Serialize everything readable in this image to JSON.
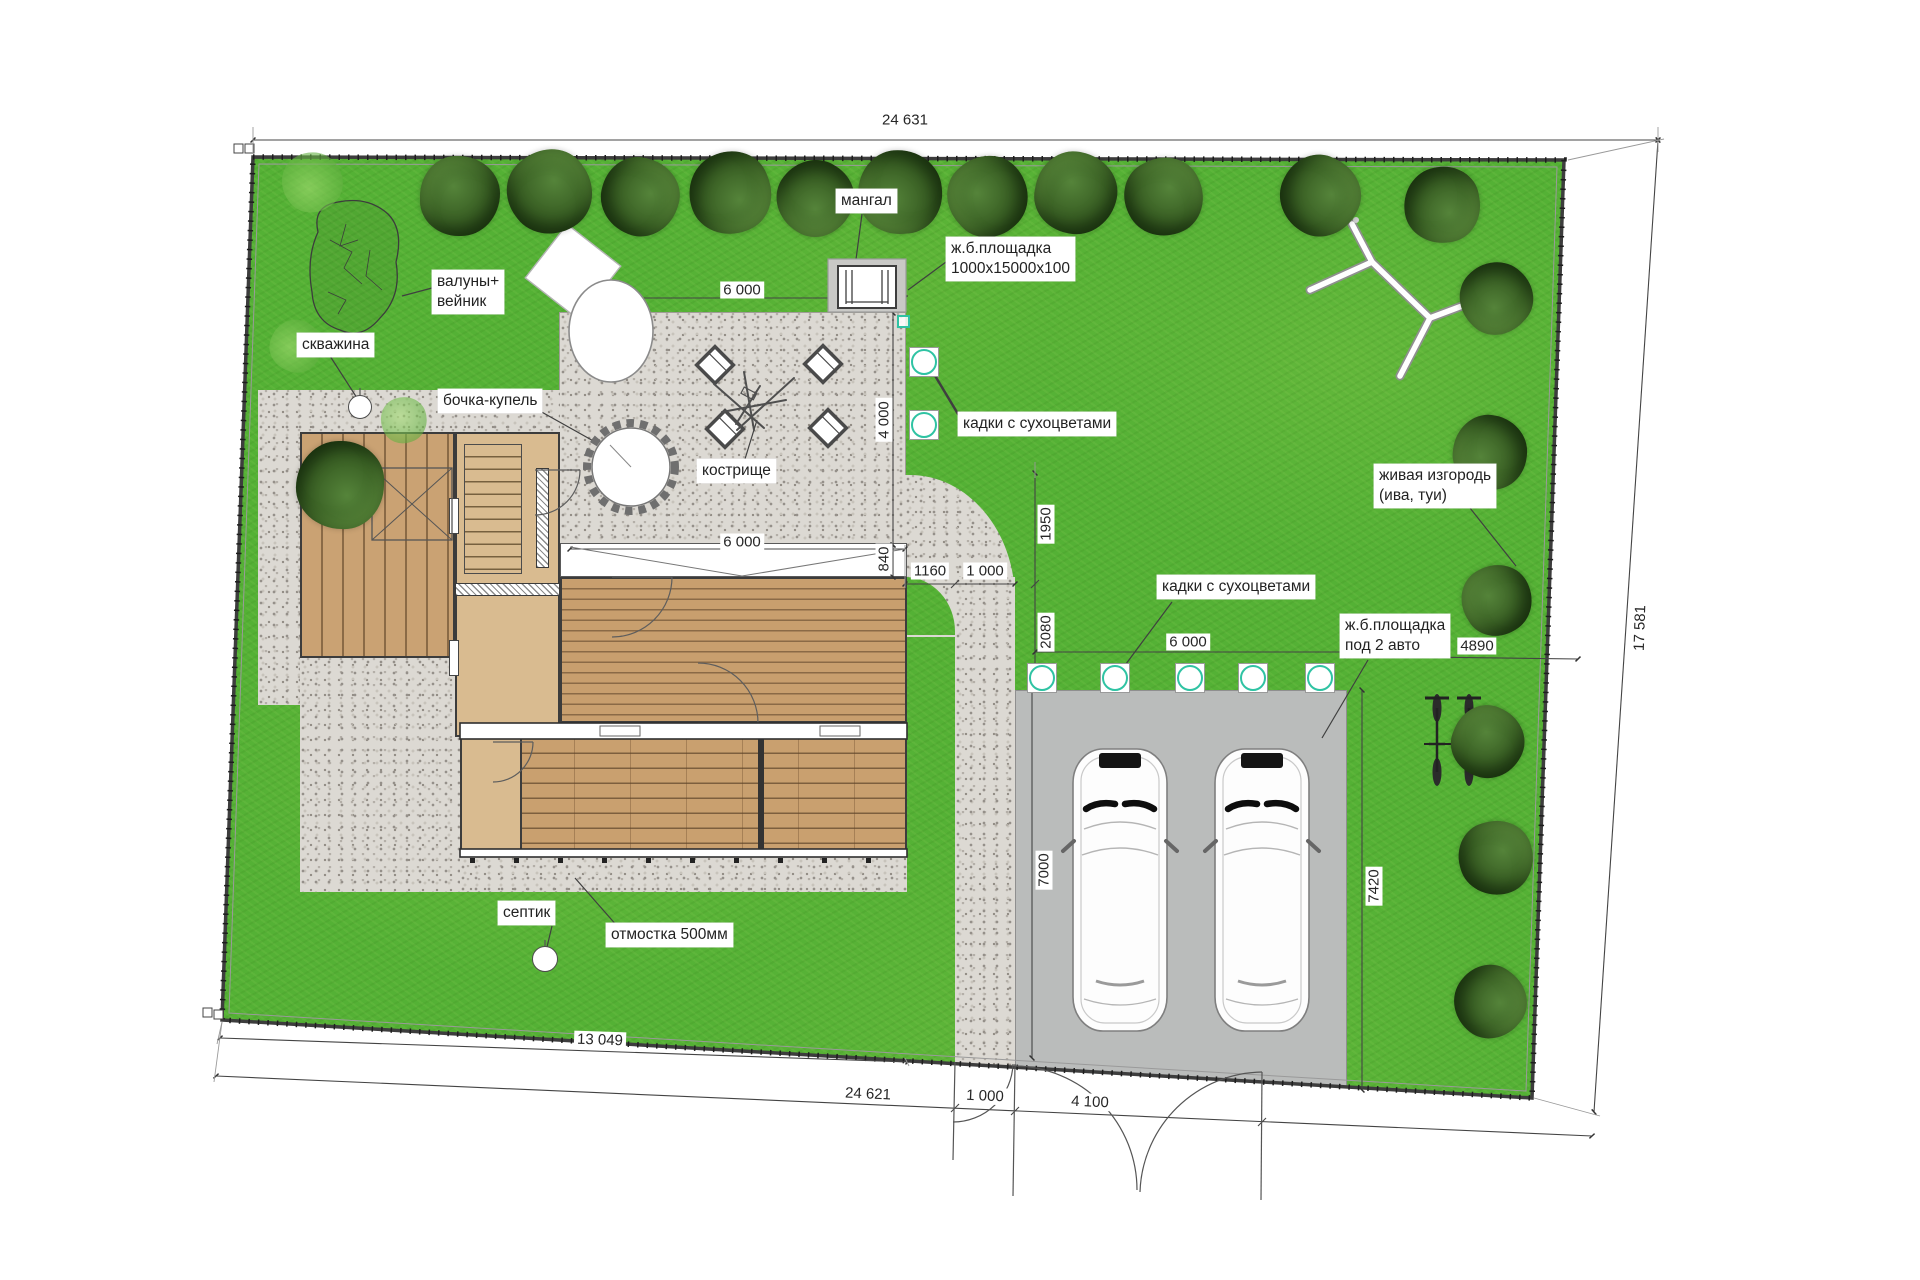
{
  "meta": {
    "drawing_type": "landscape site plan",
    "language": "ru"
  },
  "plan": {
    "colors": {
      "lawn": "#54b135",
      "gravel": "#dcd9d3",
      "parking_pad": "#babcbb",
      "deck_wood": "#c89f6e",
      "plank_line": "#8a6a46",
      "floor_tan": "#d9bb90",
      "floor_brick": "#c9a06f",
      "walls": "#3a3a3a",
      "tub_ring": "#2fc3a3",
      "fence": "#3d3d3d",
      "tree_dark": "#3c6326",
      "tree_light": "#6cb948",
      "text": "#262626"
    },
    "labels": [
      {
        "id": "mangal",
        "x": 836,
        "y": 189,
        "lines": [
          "мангал"
        ]
      },
      {
        "id": "zhb-pad",
        "x": 946,
        "y": 237,
        "lines": [
          "ж.б.площадка",
          "1000х15000х100"
        ]
      },
      {
        "id": "valuny",
        "x": 432,
        "y": 270,
        "lines": [
          "валуны+",
          "вейник"
        ]
      },
      {
        "id": "skvazhina",
        "x": 297,
        "y": 333,
        "lines": [
          "скважина"
        ]
      },
      {
        "id": "bochka-kupel",
        "x": 438,
        "y": 389,
        "lines": [
          "бочка-купель"
        ]
      },
      {
        "id": "kostrishche",
        "x": 697,
        "y": 459,
        "lines": [
          "кострище"
        ]
      },
      {
        "id": "kadki-1",
        "x": 958,
        "y": 412,
        "lines": [
          "кадки с сухоцветами"
        ]
      },
      {
        "id": "zhivaya-izgorod",
        "x": 1374,
        "y": 464,
        "lines": [
          "живая изгородь",
          "(ива, туи)"
        ]
      },
      {
        "id": "kadki-2",
        "x": 1157,
        "y": 575,
        "lines": [
          "кадки с сухоцветами"
        ]
      },
      {
        "id": "zhb-parking",
        "x": 1340,
        "y": 614,
        "lines": [
          "ж.б.площадка",
          "под 2 авто"
        ]
      },
      {
        "id": "septik",
        "x": 498,
        "y": 901,
        "lines": [
          "септик"
        ]
      },
      {
        "id": "otmostka",
        "x": 606,
        "y": 923,
        "lines": [
          "отмостка 500мм"
        ]
      }
    ],
    "dimensions": [
      {
        "id": "top-width",
        "text": "24 631",
        "x": 905,
        "y": 120,
        "rot": 0
      },
      {
        "id": "right-height",
        "text": "17 581",
        "x": 1640,
        "y": 628,
        "rot": -88
      },
      {
        "id": "bottom-left",
        "text": "13 049",
        "x": 600,
        "y": 1040,
        "rot": 2
      },
      {
        "id": "bottom-total",
        "text": "24 621",
        "x": 868,
        "y": 1094,
        "rot": 2.4
      },
      {
        "id": "patio-width",
        "text": "6 000",
        "x": 742,
        "y": 290,
        "rot": 0
      },
      {
        "id": "patio-depth",
        "text": "4 000",
        "x": 884,
        "y": 420,
        "rot": -90
      },
      {
        "id": "deck-width",
        "text": "6 000",
        "x": 742,
        "y": 542,
        "rot": 0
      },
      {
        "id": "deck-band",
        "text": "840",
        "x": 884,
        "y": 559,
        "rot": -90
      },
      {
        "id": "path-offset",
        "text": "1160",
        "x": 930,
        "y": 571,
        "rot": 0
      },
      {
        "id": "path-width-top",
        "text": "1 000",
        "x": 985,
        "y": 571,
        "rot": 0
      },
      {
        "id": "tub-gap-1",
        "text": "1950",
        "x": 1046,
        "y": 524,
        "rot": -90
      },
      {
        "id": "tub-gap-2",
        "text": "2080",
        "x": 1046,
        "y": 632,
        "rot": -90
      },
      {
        "id": "tub-row-width",
        "text": "6 000",
        "x": 1188,
        "y": 642,
        "rot": 0
      },
      {
        "id": "parking-east-gap",
        "text": "4890",
        "x": 1477,
        "y": 646,
        "rot": 0
      },
      {
        "id": "parking-depth",
        "text": "7000",
        "x": 1044,
        "y": 870,
        "rot": -90
      },
      {
        "id": "parking-depth-east",
        "text": "7420",
        "x": 1374,
        "y": 886,
        "rot": -90
      },
      {
        "id": "gate-walk",
        "text": "1 000",
        "x": 985,
        "y": 1096,
        "rot": 2.4
      },
      {
        "id": "gate-drive",
        "text": "4 100",
        "x": 1090,
        "y": 1102,
        "rot": 2.4
      }
    ],
    "vegetation": {
      "trees": [
        {
          "x": 460,
          "y": 196,
          "r": 40
        },
        {
          "x": 550,
          "y": 192,
          "r": 42
        },
        {
          "x": 640,
          "y": 197,
          "r": 39
        },
        {
          "x": 730,
          "y": 193,
          "r": 41
        },
        {
          "x": 815,
          "y": 198,
          "r": 38
        },
        {
          "x": 900,
          "y": 192,
          "r": 42
        },
        {
          "x": 988,
          "y": 196,
          "r": 40
        },
        {
          "x": 1076,
          "y": 193,
          "r": 41
        },
        {
          "x": 1164,
          "y": 197,
          "r": 39
        },
        {
          "x": 1320,
          "y": 196,
          "r": 40
        },
        {
          "x": 1442,
          "y": 205,
          "r": 38
        },
        {
          "x": 1496,
          "y": 298,
          "r": 36
        },
        {
          "x": 1490,
          "y": 452,
          "r": 37
        },
        {
          "x": 1497,
          "y": 600,
          "r": 35
        },
        {
          "x": 1488,
          "y": 742,
          "r": 36
        },
        {
          "x": 1496,
          "y": 858,
          "r": 37
        },
        {
          "x": 1490,
          "y": 1002,
          "r": 36
        },
        {
          "x": 340,
          "y": 485,
          "r": 44
        },
        {
          "x": 312,
          "y": 182,
          "r": 30,
          "type": "light"
        },
        {
          "x": 296,
          "y": 346,
          "r": 26,
          "type": "light"
        },
        {
          "x": 404,
          "y": 420,
          "r": 23,
          "type": "light"
        }
      ]
    },
    "tubs": [
      {
        "x": 924,
        "y": 362,
        "s": 30
      },
      {
        "x": 924,
        "y": 425,
        "s": 30
      },
      {
        "x": 1042,
        "y": 678,
        "s": 30
      },
      {
        "x": 1115,
        "y": 678,
        "s": 30
      },
      {
        "x": 1190,
        "y": 678,
        "s": 30
      },
      {
        "x": 1253,
        "y": 678,
        "s": 30
      },
      {
        "x": 1320,
        "y": 678,
        "s": 30
      },
      {
        "x": 903,
        "y": 321,
        "s": 13,
        "mini": true
      }
    ],
    "wells": [
      {
        "id": "skvazhina-well",
        "x": 360,
        "y": 407,
        "r": 12
      },
      {
        "id": "septik-well",
        "x": 545,
        "y": 959,
        "r": 13
      }
    ],
    "objects": {
      "cars": 2,
      "bicycles": 2,
      "fire_pit_seats": 4
    }
  }
}
